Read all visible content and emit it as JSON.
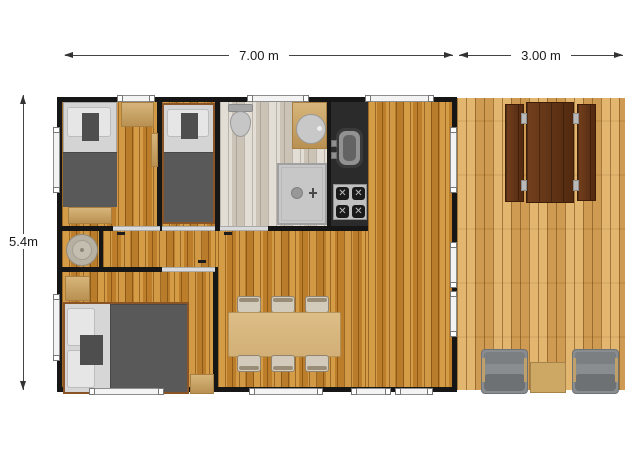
{
  "page": {
    "type": "cabin-floor-plan",
    "background": "#ffffff"
  },
  "annotations": {
    "width_main_label": "7.00 m",
    "width_deck_label": "3.00 m",
    "height_label": "5.4m"
  },
  "palette": {
    "wall": "#161616",
    "interior_wood_floor": "#c98b33",
    "deck_wood": "#d9a75d",
    "bathroom_floor": "#d3ccc0",
    "kitchen_counter": "#2b2b2b",
    "bedding_dark": "#595959",
    "mattress_light": "#d4d4d4",
    "light_furniture_wood": "#c9a160",
    "picnic_table_wood": "#5e2f12",
    "armchair_grey": "#8a8d90",
    "dimension_line": "#444444"
  },
  "rooms": [
    {
      "name": "bedroom-twin",
      "furniture": [
        "single-bed",
        "bench",
        "wall-table",
        "wall-shelf"
      ]
    },
    {
      "name": "bedroom-single",
      "furniture": [
        "single-bed"
      ]
    },
    {
      "name": "bathroom",
      "furniture": [
        "toilet",
        "round-washbasin",
        "shower"
      ]
    },
    {
      "name": "kitchen",
      "furniture": [
        "counter",
        "sink",
        "stove-4-burner"
      ]
    },
    {
      "name": "living-dining",
      "furniture": [
        "dining-table",
        "dining-chair x6"
      ]
    },
    {
      "name": "hallway",
      "furniture": [
        "water-heater"
      ]
    },
    {
      "name": "bedroom-double",
      "furniture": [
        "double-bed",
        "nightstand x2"
      ]
    },
    {
      "name": "terrace-deck",
      "furniture": [
        "picnic-table",
        "armchair x2",
        "side-table"
      ]
    }
  ]
}
